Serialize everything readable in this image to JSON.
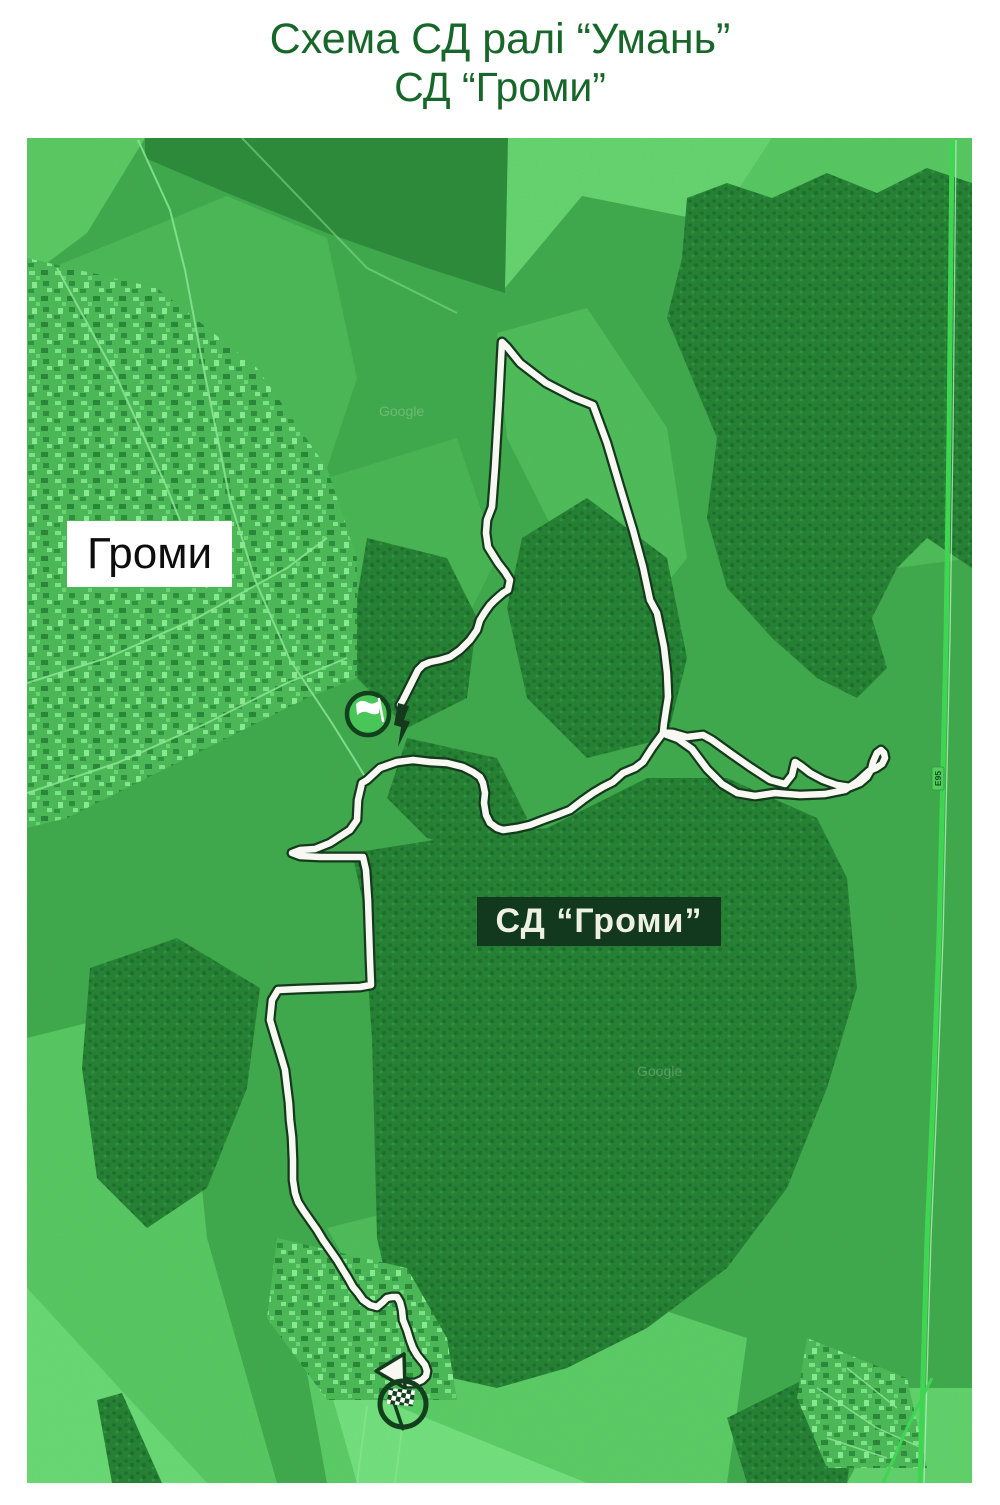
{
  "title": {
    "line1": "Схема СД ралі “Умань”",
    "line2": "СД “Громи”"
  },
  "map": {
    "village_label": "Громи",
    "stage_label": "СД “Громи”",
    "road_shield": "E95",
    "watermark": "Google",
    "markers": {
      "start": "start-flag",
      "finish": "finish-checkered-flag"
    },
    "colors": {
      "title_text": "#17672a",
      "map_base_green": "#41a94c",
      "field_bright": "#66d46f",
      "forest_dark": "#268034",
      "route_fill": "#f8f8f2",
      "route_outline": "#14391d",
      "highway_green": "#3fd853",
      "village_label_bg": "#ffffff",
      "village_label_text": "#0d0d0d",
      "stage_label_bg": "#12381d",
      "stage_label_text": "#eef0e2",
      "marker_ring": "#123f1c",
      "start_marker_fill": "#49c658"
    }
  }
}
